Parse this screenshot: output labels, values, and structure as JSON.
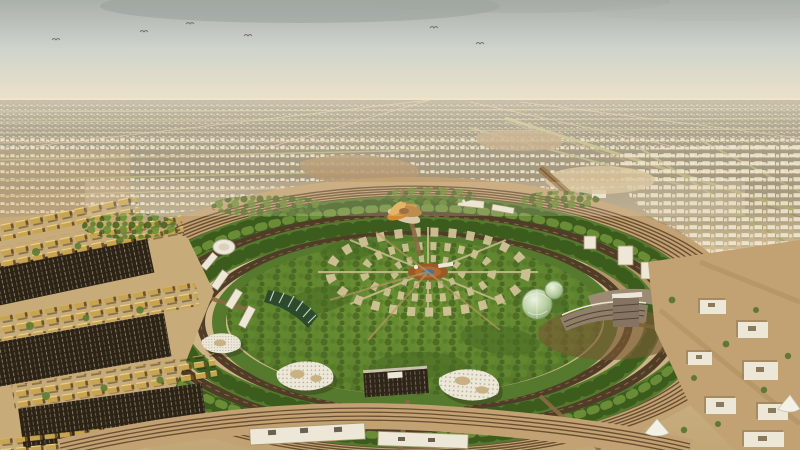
{
  "meta": {
    "title": "Aerial masterplan rendering",
    "description": "Aerial architectural rendering of a circular park campus surrounded by ring roads and rail tracks, set in a sprawling sandy desert city under a hazy sky; white organic buildings, glass domes and an orange petal pavilion dot the green rings, with golden townhouses to the left and white office blocks to the right"
  },
  "palette": {
    "sky-top": "#aab0aa",
    "sky-mid": "#ced4cc",
    "sky-horizon": "#e9e0c9",
    "sky-glow": "#f0e6cc",
    "sand-far": "#ead festivalsdcbe",
    "sand-mid": "#d8c296",
    "sand-near": "#c2a676",
    "green-light": "#74963a",
    "green-light2": "#6f9138",
    "green-mid": "#557a2e",
    "green-mid2": "#5d8030",
    "green-dark": "#3f5f22",
    "green-dark2": "#3c5c1e",
    "road-dark": "#503d28",
    "track-brown": "#5a4126",
    "ring-base": "#c2a173",
    "park-path": "#d7c79c",
    "building-white": "#ece7d7",
    "building-shadow": "#a7966f",
    "villa-gold": "#c9a44f",
    "parking-dark": "#2c2315",
    "pond-blue": "#3f72a8",
    "pavilion-orange": "#d28a2f",
    "dome-glass": "#b7cfa0",
    "glass-hi": "#edf3e2",
    "glass-dk": "#7e9868",
    "taupe": "#8f7e68",
    "olive-trees": "#9a9a50"
  }
}
